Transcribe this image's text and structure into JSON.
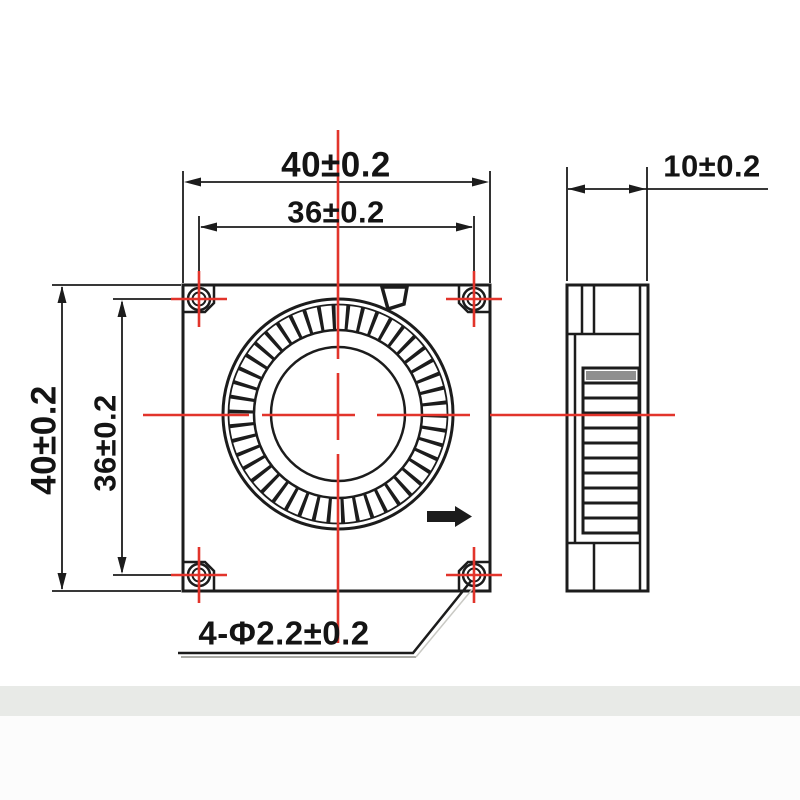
{
  "drawing": {
    "colors": {
      "linework": "#1c1c1c",
      "centerline_red": "#e2342b",
      "vent_slat_gray": "#8f8f8f",
      "footer_band": "#e8eae7"
    },
    "front_view": {
      "dimensions": {
        "width_top": "40±0.2",
        "hole_spacing_top": "36±0.2",
        "height_left": "40±0.2",
        "hole_spacing_left": "36±0.2",
        "mounting_holes": "4-Φ2.2±0.2"
      },
      "icons": {
        "rotation_direction": "right-arrow"
      }
    },
    "side_view": {
      "dimensions": {
        "depth_top": "10±0.2"
      }
    }
  }
}
